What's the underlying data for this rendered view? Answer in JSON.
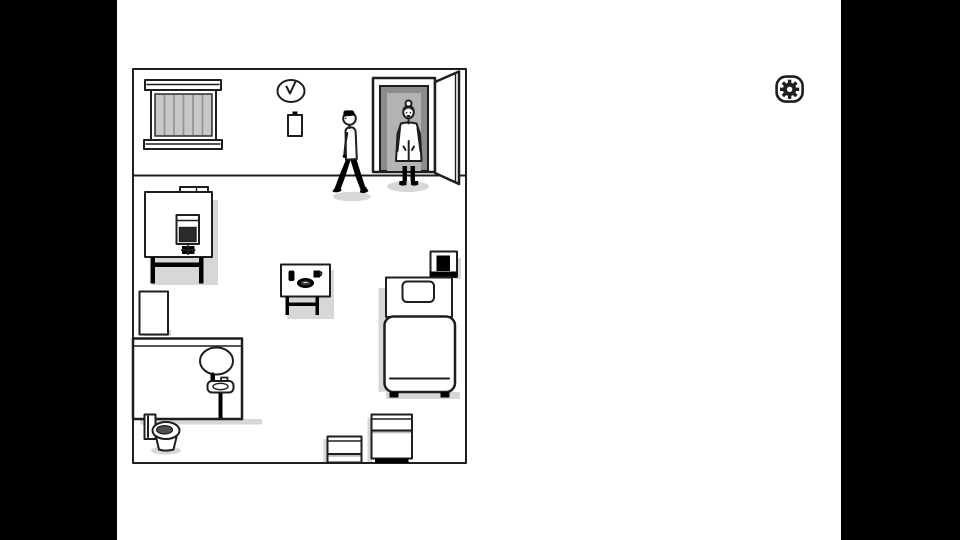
{
  "scene": {
    "description": "line-art hospital room scene with letterboxed black side bars",
    "objects": [
      "barred-window",
      "wall-clock",
      "note-paper",
      "walking-man",
      "nurse-in-doorway",
      "open-door",
      "machine-table",
      "towels",
      "storage-box-tall",
      "bathroom-partition",
      "mirror",
      "pedestal-sink",
      "toilet",
      "meal-table",
      "drinking-glass",
      "food-plate",
      "cup",
      "bed",
      "pillow",
      "nightstand",
      "small-crate",
      "large-crate"
    ]
  },
  "hud": {
    "settings_icon": "gear-icon"
  },
  "colors": {
    "ink": "#1e1e1e",
    "paper": "#ffffff",
    "letterbox": "#000000",
    "shadow": "#d7d7d7",
    "window_glass": "#c7c7c7",
    "window_bar_line": "#8f8f8f",
    "jamb_dark": "#8c8c8c",
    "jamb_light": "#b3b3b3",
    "screen_dark": "#2a2a2a",
    "plate_dark": "#3f3f3f",
    "seat_dark": "#4f4f4f",
    "crate_band": "#bdbdbd"
  }
}
